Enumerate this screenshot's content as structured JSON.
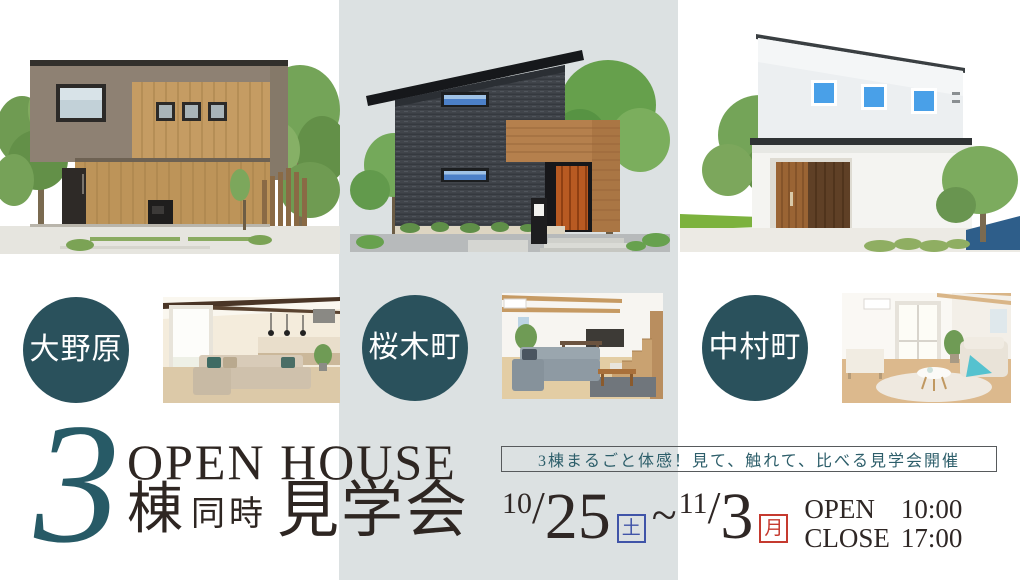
{
  "poster": {
    "headline": {
      "count": "3",
      "english": "OPEN HOUSE",
      "unit": "棟",
      "middle": "同時",
      "event": "見学会"
    },
    "banner_text": "3棟まるごと体感！見て、触れて、比べる見学会開催",
    "locations": [
      {
        "name": "大野原"
      },
      {
        "name": "桜木町"
      },
      {
        "name": "中村町"
      }
    ],
    "schedule": {
      "slash": "/",
      "start": {
        "month": "10",
        "day": "25",
        "weekday": "土"
      },
      "separator": "~",
      "end": {
        "month": "11",
        "day": "3",
        "weekday": "月"
      },
      "hours": [
        {
          "label": "OPEN",
          "time": "10:00"
        },
        {
          "label": "CLOSE",
          "time": "17:00"
        }
      ]
    },
    "colors": {
      "accent_teal": "#2a515c",
      "band_gray": "#dce1e2",
      "saturday_blue": "#4054a8",
      "monday_red": "#c53a2f",
      "text_dark": "#2f2725"
    }
  }
}
